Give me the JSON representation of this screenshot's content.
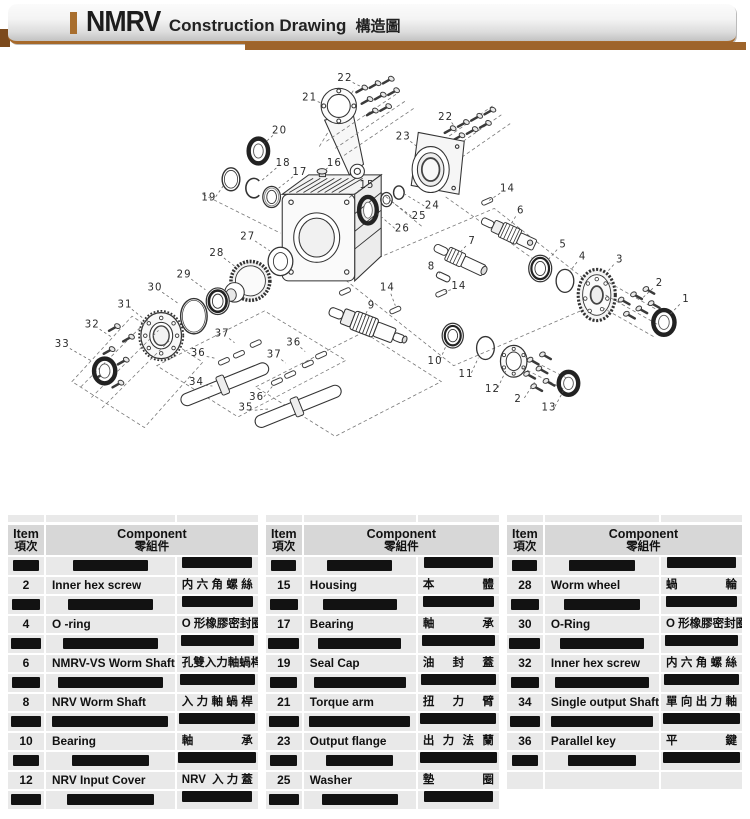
{
  "header": {
    "brand": "NMRV",
    "title_en": "Construction Drawing",
    "title_zh": "構造圖"
  },
  "colors": {
    "accent_brown": "#a6692b",
    "underbar_brown": "#9e642b",
    "table_header_bg": "#d7d7d7",
    "table_row_bg": "#e9e9e9",
    "redaction": "#121212"
  },
  "diagram": {
    "labels": [
      {
        "t": "1",
        "x": 727,
        "y": 330,
        "tx": 708,
        "ty": 349
      },
      {
        "t": "2",
        "x": 697,
        "y": 312,
        "tx": 676,
        "ty": 331
      },
      {
        "t": "2",
        "x": 537,
        "y": 443,
        "tx": 556,
        "ty": 424
      },
      {
        "t": "3",
        "x": 652,
        "y": 285,
        "tx": 637,
        "ty": 301
      },
      {
        "t": "4",
        "x": 610,
        "y": 282,
        "tx": 595,
        "ty": 300
      },
      {
        "t": "5",
        "x": 588,
        "y": 268,
        "tx": 571,
        "ty": 286
      },
      {
        "t": "6",
        "x": 540,
        "y": 230,
        "tx": 528,
        "ty": 247
      },
      {
        "t": "7",
        "x": 485,
        "y": 264,
        "tx": 468,
        "ty": 281
      },
      {
        "t": "8",
        "x": 439,
        "y": 293,
        "tx": 450,
        "ty": 303
      },
      {
        "t": "9",
        "x": 371,
        "y": 337,
        "tx": 363,
        "ty": 351
      },
      {
        "t": "10",
        "x": 443,
        "y": 400,
        "tx": 456,
        "ty": 382
      },
      {
        "t": "11",
        "x": 478,
        "y": 415,
        "tx": 492,
        "ty": 397
      },
      {
        "t": "12",
        "x": 508,
        "y": 432,
        "tx": 523,
        "ty": 412
      },
      {
        "t": "13",
        "x": 572,
        "y": 453,
        "tx": 588,
        "ty": 435
      },
      {
        "t": "14",
        "x": 525,
        "y": 205,
        "tx": 504,
        "ty": 219
      },
      {
        "t": "14",
        "x": 470,
        "y": 315,
        "tx": 454,
        "ty": 322
      },
      {
        "t": "14",
        "x": 389,
        "y": 317,
        "tx": 398,
        "ty": 338
      },
      {
        "t": "15",
        "x": 366,
        "y": 201,
        "tx": 344,
        "ty": 217
      },
      {
        "t": "16",
        "x": 329,
        "y": 176,
        "tx": 318,
        "ty": 185
      },
      {
        "t": "17",
        "x": 290,
        "y": 186,
        "tx": 266,
        "ty": 205
      },
      {
        "t": "18",
        "x": 271,
        "y": 176,
        "tx": 246,
        "ty": 197
      },
      {
        "t": "19",
        "x": 187,
        "y": 215,
        "tx": 205,
        "ty": 200
      },
      {
        "t": "20",
        "x": 267,
        "y": 139,
        "tx": 250,
        "ty": 154
      },
      {
        "t": "21",
        "x": 301,
        "y": 102,
        "tx": 321,
        "ty": 111
      },
      {
        "t": "22",
        "x": 341,
        "y": 80,
        "tx": 359,
        "ty": 90
      },
      {
        "t": "22",
        "x": 455,
        "y": 124,
        "tx": 465,
        "ty": 135
      },
      {
        "t": "23",
        "x": 407,
        "y": 146,
        "tx": 424,
        "ty": 159
      },
      {
        "t": "24",
        "x": 440,
        "y": 224,
        "tx": 409,
        "ty": 212
      },
      {
        "t": "25",
        "x": 425,
        "y": 236,
        "tx": 395,
        "ty": 221
      },
      {
        "t": "26",
        "x": 406,
        "y": 250,
        "tx": 378,
        "ty": 234
      },
      {
        "t": "27",
        "x": 231,
        "y": 259,
        "tx": 256,
        "ty": 276
      },
      {
        "t": "28",
        "x": 196,
        "y": 278,
        "tx": 217,
        "ty": 294
      },
      {
        "t": "29",
        "x": 159,
        "y": 302,
        "tx": 183,
        "ty": 320
      },
      {
        "t": "30",
        "x": 126,
        "y": 317,
        "tx": 153,
        "ty": 336
      },
      {
        "t": "31",
        "x": 92,
        "y": 336,
        "tx": 112,
        "ty": 352
      },
      {
        "t": "32",
        "x": 55,
        "y": 359,
        "tx": 76,
        "ty": 373
      },
      {
        "t": "33",
        "x": 21,
        "y": 381,
        "tx": 53,
        "ty": 400
      },
      {
        "t": "34",
        "x": 173,
        "y": 424,
        "tx": 191,
        "ty": 429
      },
      {
        "t": "35",
        "x": 229,
        "y": 453,
        "tx": 255,
        "ty": 455
      },
      {
        "t": "36",
        "x": 175,
        "y": 391,
        "tx": 196,
        "ty": 398
      },
      {
        "t": "36",
        "x": 283,
        "y": 379,
        "tx": 296,
        "ty": 390
      },
      {
        "t": "36",
        "x": 241,
        "y": 441,
        "tx": 260,
        "ty": 428
      },
      {
        "t": "37",
        "x": 202,
        "y": 369,
        "tx": 216,
        "ty": 380
      },
      {
        "t": "37",
        "x": 261,
        "y": 393,
        "tx": 274,
        "ty": 403
      }
    ]
  },
  "table": {
    "header": {
      "item_en": "Item",
      "item_zh": "項次",
      "comp_en": "Component",
      "comp_zh": "零組件"
    },
    "groups": [
      {
        "rows": [
          {
            "redacted": true
          },
          {
            "item": "2",
            "en": "Inner hex screw",
            "zh": "内六角螺絲"
          },
          {
            "redacted": true
          },
          {
            "item": "4",
            "en": "O -ring",
            "zh": "O 形橡膠密封圈"
          },
          {
            "redacted": true
          },
          {
            "item": "6",
            "en": "NMRV-VS Worm Shaft",
            "zh": "孔雙入力軸蝸桿"
          },
          {
            "redacted": true
          },
          {
            "item": "8",
            "en": "NRV Worm Shaft",
            "zh": "入力軸蝸桿"
          },
          {
            "redacted": true
          },
          {
            "item": "10",
            "en": "Bearing",
            "zh": "軸承"
          },
          {
            "redacted": true
          },
          {
            "item": "12",
            "en": "NRV Input Cover",
            "zh": "NRV 入力蓋"
          },
          {
            "redacted": true
          }
        ]
      },
      {
        "rows": [
          {
            "redacted": true
          },
          {
            "item": "15",
            "en": "Housing",
            "zh": "本體"
          },
          {
            "redacted": true
          },
          {
            "item": "17",
            "en": "Bearing",
            "zh": "軸承"
          },
          {
            "redacted": true
          },
          {
            "item": "19",
            "en": "Seal Cap",
            "zh": "油封蓋"
          },
          {
            "redacted": true
          },
          {
            "item": "21",
            "en": "Torque arm",
            "zh": "扭力臂"
          },
          {
            "redacted": true
          },
          {
            "item": "23",
            "en": "Output flange",
            "zh": "出力法蘭"
          },
          {
            "redacted": true
          },
          {
            "item": "25",
            "en": "Washer",
            "zh": "墊圈"
          },
          {
            "redacted": true
          }
        ]
      },
      {
        "rows": [
          {
            "redacted": true
          },
          {
            "item": "28",
            "en": "Worm wheel",
            "zh": "蝸輪"
          },
          {
            "redacted": true
          },
          {
            "item": "30",
            "en": "O-Ring",
            "zh": "O 形橡膠密封圈"
          },
          {
            "redacted": true
          },
          {
            "item": "32",
            "en": "Inner hex screw",
            "zh": "内六角螺絲"
          },
          {
            "redacted": true
          },
          {
            "item": "34",
            "en": "Single output Shaft",
            "zh": "單向出力軸"
          },
          {
            "redacted": true
          },
          {
            "item": "36",
            "en": "Parallel key",
            "zh": "平鍵"
          },
          {
            "redacted": true
          },
          {
            "empty": true
          },
          {
            "absent": true
          }
        ]
      }
    ]
  }
}
